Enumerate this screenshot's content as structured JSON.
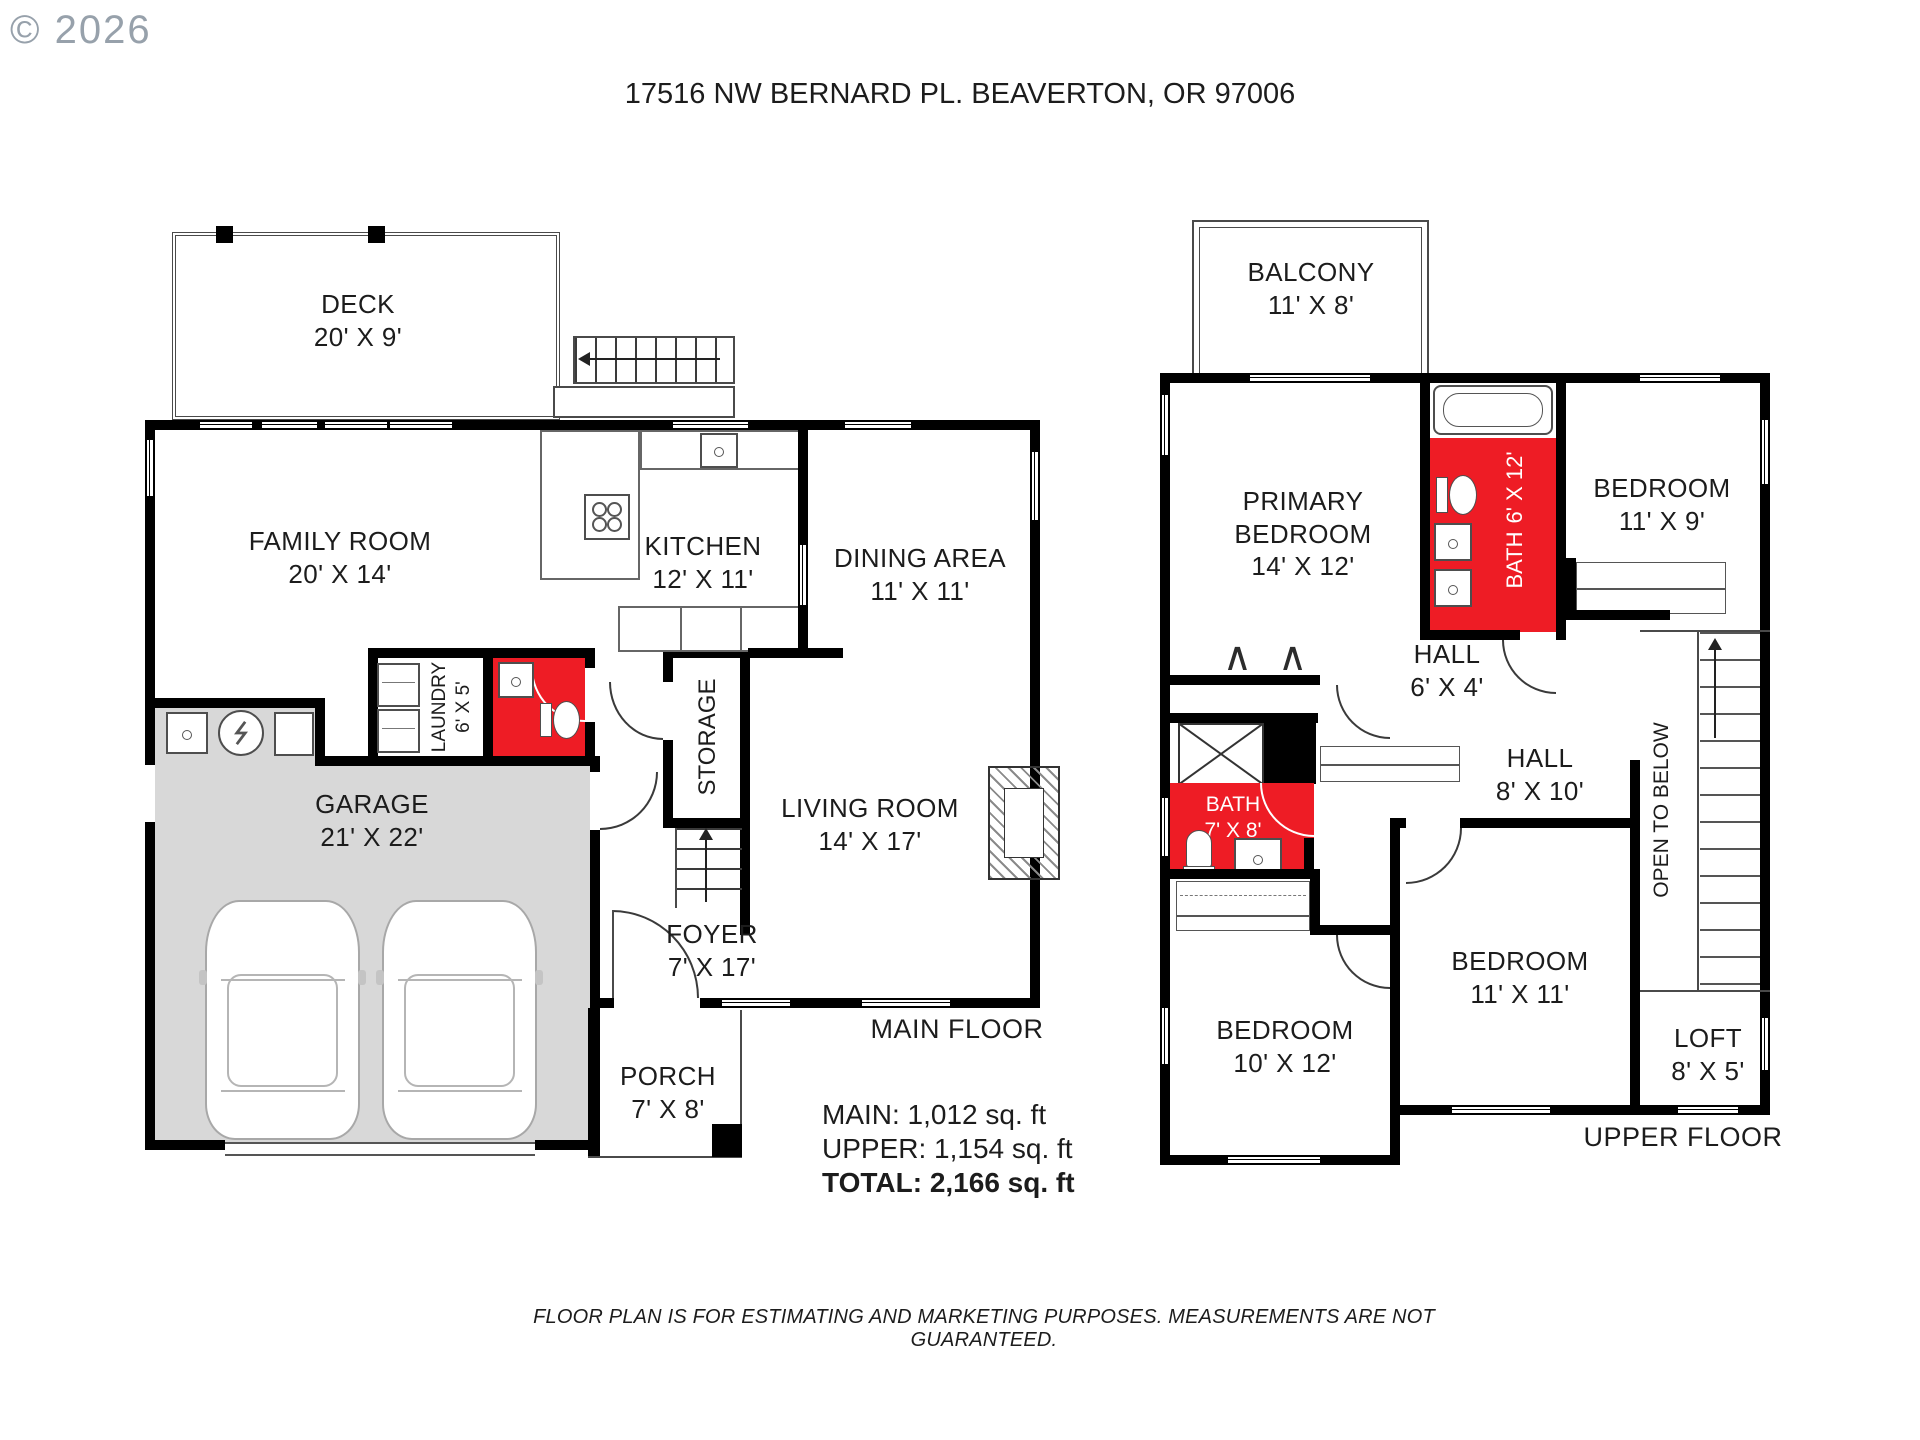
{
  "page": {
    "copyright": "© 2026",
    "title": "17516 NW BERNARD PL. BEAVERTON, OR 97006",
    "disclaimer": "FLOOR PLAN IS FOR ESTIMATING AND MARKETING PURPOSES. MEASUREMENTS ARE NOT GUARANTEED."
  },
  "colors": {
    "bath_red": "#ee1c25",
    "garage_grey": "#d8d8d8",
    "wall": "#000000"
  },
  "main_floor": {
    "floor_label": "MAIN FLOOR",
    "areas": {
      "main": "MAIN: 1,012 sq. ft",
      "upper": "UPPER: 1,154 sq. ft",
      "total": "TOTAL: 2,166 sq. ft"
    },
    "rooms": {
      "deck": {
        "name": "DECK",
        "dims": "20' X 9'"
      },
      "family_room": {
        "name": "FAMILY ROOM",
        "dims": "20' X 14'"
      },
      "kitchen": {
        "name": "KITCHEN",
        "dims": "12' X 11'"
      },
      "dining_area": {
        "name": "DINING AREA",
        "dims": "11' X 11'"
      },
      "laundry": {
        "name": "LAUNDRY",
        "dims": "6' X 5'"
      },
      "storage": {
        "name": "STORAGE"
      },
      "garage": {
        "name": "GARAGE",
        "dims": "21' X 22'"
      },
      "living_room": {
        "name": "LIVING ROOM",
        "dims": "14' X 17'"
      },
      "foyer": {
        "name": "FOYER",
        "dims": "7' X 17'"
      },
      "porch": {
        "name": "PORCH",
        "dims": "7' X 8'"
      }
    }
  },
  "upper_floor": {
    "floor_label": "UPPER FLOOR",
    "rooms": {
      "balcony": {
        "name": "BALCONY",
        "dims": "11' X 8'"
      },
      "primary_bedroom": {
        "name": "PRIMARY BEDROOM",
        "dims": "14' X 12'"
      },
      "bath_6x12": {
        "name": "BATH",
        "dims": "6' X 12'"
      },
      "bedroom_11x9": {
        "name": "BEDROOM",
        "dims": "11' X 9'"
      },
      "hall_6x4": {
        "name": "HALL",
        "dims": "6' X 4'"
      },
      "hall_8x10": {
        "name": "HALL",
        "dims": "8' X 10'"
      },
      "bath_7x8": {
        "name": "BATH",
        "dims": "7' X 8'"
      },
      "open_to_below": {
        "name": "OPEN TO BELOW"
      },
      "bedroom_10x12": {
        "name": "BEDROOM",
        "dims": "10' X 12'"
      },
      "bedroom_11x11": {
        "name": "BEDROOM",
        "dims": "11' X 11'"
      },
      "loft": {
        "name": "LOFT",
        "dims": "8' X 5'"
      }
    }
  }
}
